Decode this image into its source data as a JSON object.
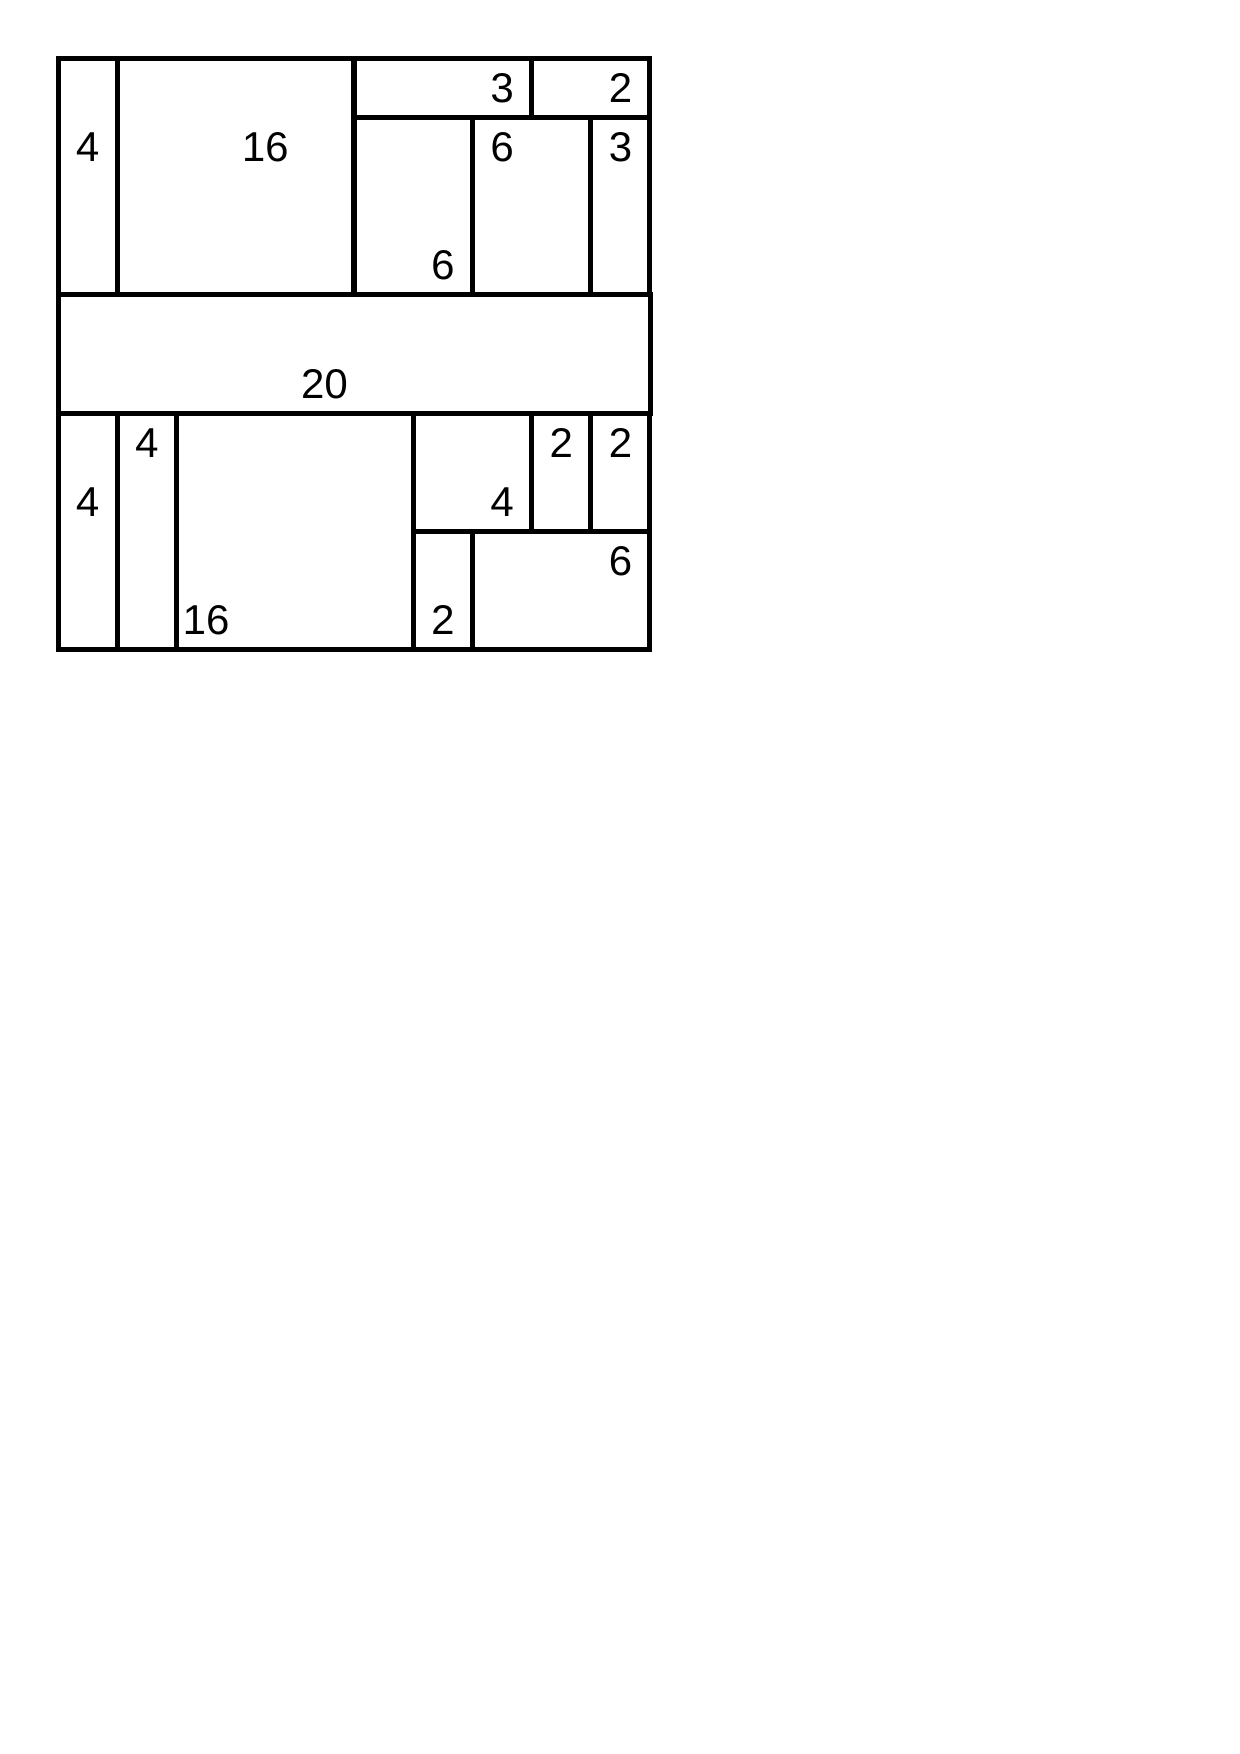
{
  "page": {
    "width": 1240,
    "height": 1754,
    "background": "#ffffff"
  },
  "puzzle": {
    "kind": "shikaku-rectangle-partition-solution",
    "grid": {
      "cols": 10,
      "rows": 10,
      "origin_x": 58,
      "origin_y": 58,
      "unit": 59.2,
      "stroke_width": 5,
      "line_color": "#000000",
      "background": "#ffffff",
      "label_color": "#000000",
      "label_font_size": 42
    },
    "total_area": 100,
    "rectangles": [
      {
        "label": "4",
        "x": 0,
        "y": 0,
        "w": 1,
        "h": 4,
        "label_col": 0,
        "label_row": 1
      },
      {
        "label": "16",
        "x": 1,
        "y": 0,
        "w": 4,
        "h": 4,
        "label_col": 3,
        "label_row": 1
      },
      {
        "label": "3",
        "x": 5,
        "y": 0,
        "w": 3,
        "h": 1,
        "label_col": 7,
        "label_row": 0
      },
      {
        "label": "2",
        "x": 8,
        "y": 0,
        "w": 2,
        "h": 1,
        "label_col": 9,
        "label_row": 0
      },
      {
        "label": "6",
        "x": 5,
        "y": 1,
        "w": 2,
        "h": 3,
        "label_col": 6,
        "label_row": 3
      },
      {
        "label": "6",
        "x": 7,
        "y": 1,
        "w": 2,
        "h": 3,
        "label_col": 7,
        "label_row": 1
      },
      {
        "label": "3",
        "x": 9,
        "y": 1,
        "w": 1,
        "h": 3,
        "label_col": 9,
        "label_row": 1
      },
      {
        "label": "20",
        "x": 0,
        "y": 4,
        "w": 10,
        "h": 2,
        "label_col": 4,
        "label_row": 5
      },
      {
        "label": "4",
        "x": 0,
        "y": 6,
        "w": 1,
        "h": 4,
        "label_col": 0,
        "label_row": 7
      },
      {
        "label": "4",
        "x": 1,
        "y": 6,
        "w": 1,
        "h": 4,
        "label_col": 1,
        "label_row": 6
      },
      {
        "label": "16",
        "x": 2,
        "y": 6,
        "w": 4,
        "h": 4,
        "label_col": 2,
        "label_row": 9
      },
      {
        "label": "4",
        "x": 6,
        "y": 6,
        "w": 2,
        "h": 2,
        "label_col": 7,
        "label_row": 7
      },
      {
        "label": "2",
        "x": 8,
        "y": 6,
        "w": 1,
        "h": 2,
        "label_col": 8,
        "label_row": 6
      },
      {
        "label": "2",
        "x": 9,
        "y": 6,
        "w": 1,
        "h": 2,
        "label_col": 9,
        "label_row": 6
      },
      {
        "label": "2",
        "x": 6,
        "y": 8,
        "w": 1,
        "h": 2,
        "label_col": 6,
        "label_row": 9
      },
      {
        "label": "6",
        "x": 7,
        "y": 8,
        "w": 3,
        "h": 2,
        "label_col": 9,
        "label_row": 8
      }
    ]
  }
}
